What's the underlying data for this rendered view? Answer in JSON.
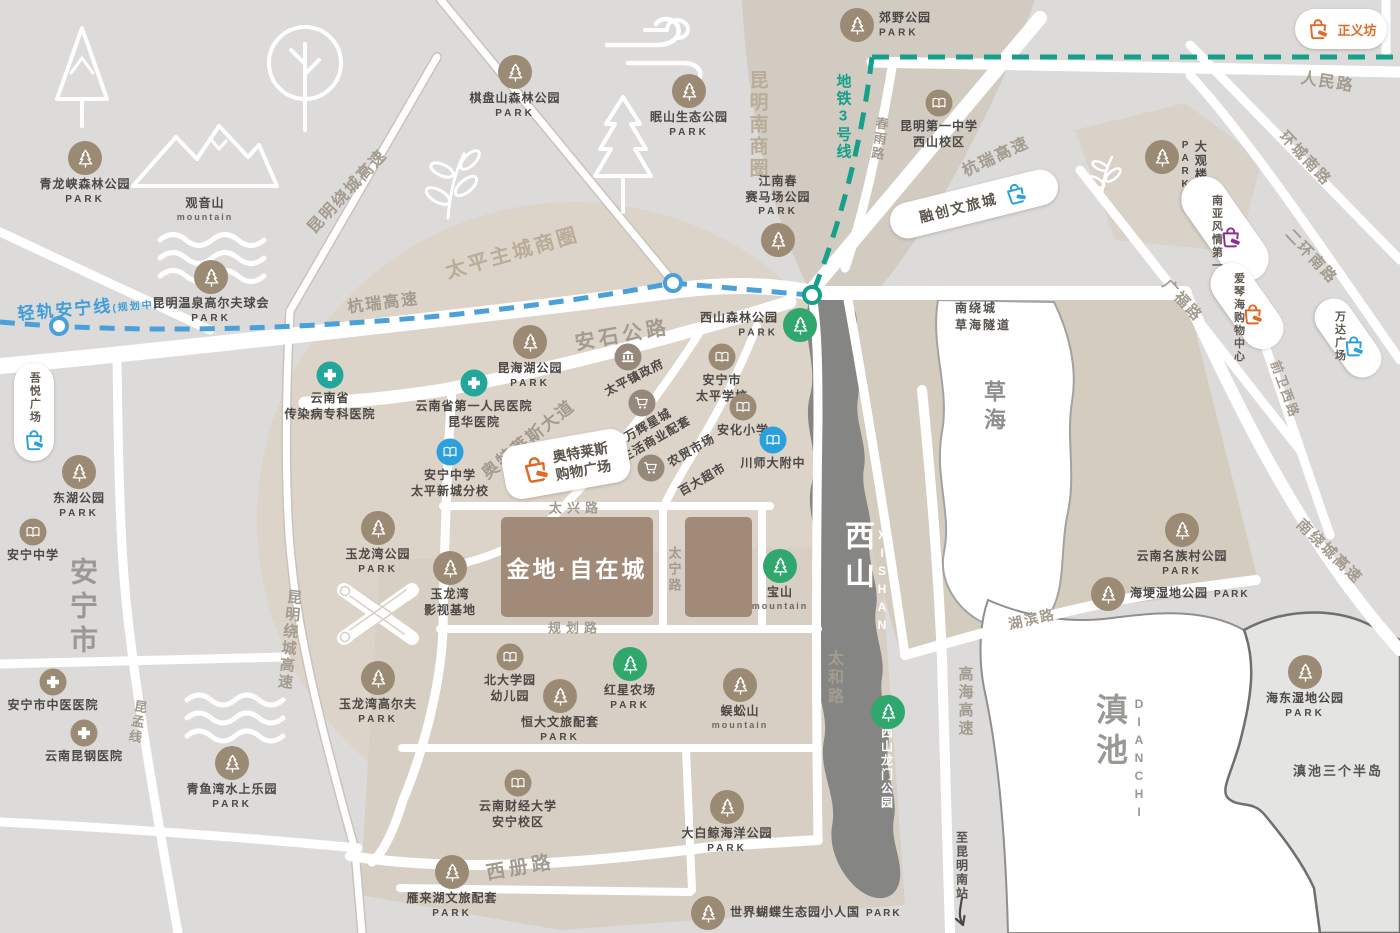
{
  "project": {
    "name": "金地·自在城"
  },
  "transit": {
    "metro": "地铁3号线",
    "lrt": "轻轨安宁线",
    "lrtNote": "(规划中)"
  },
  "areas": {
    "anning": "安宁市",
    "caohai": "草海",
    "xishan": "西山",
    "xishanEn": "XISHAN",
    "dianchi": "滇池",
    "dianchiEn": "DIANCHI",
    "bizSouth": "昆明南商圈",
    "bizTaiping": "太平主城商圈",
    "peninsula": "滇池三个半岛",
    "tunnel": "南绕城",
    "tunnel2": "草海隧道",
    "toStation": "至昆明南站"
  },
  "roads": {
    "raocheng": "昆明绕城高速",
    "hangrui": "杭瑞高速",
    "anshi": "安石公路",
    "aoteDadao": "奥特莱斯大道",
    "taixing": "太兴路",
    "guihua": "规划路",
    "taining": "太宁路",
    "xice": "西册路",
    "taihe": "太和路",
    "hubin": "湖滨路",
    "gaohai": "高海高速",
    "nanrao": "南绕城高速",
    "renmin": "人民路",
    "huancheng": "环城南路",
    "erhuan": "二环南路",
    "guangfu": "广福路",
    "qianwei": "前卫西路",
    "chunyu": "春雨路",
    "kunmeng": "昆孟线"
  },
  "malls": {
    "zhengyifang": "正义坊",
    "rongchuang": "融创文旅城",
    "nanya": "南亚风情第一城",
    "aiqinhai": "爱琴海购物中心",
    "wanda": "万达广场",
    "wuyue": "吾悦广场",
    "aotelaisi": {
      "l1": "奥特莱斯",
      "l2": "购物广场"
    }
  },
  "pois": {
    "qipanshan": {
      "n": "棋盘山森林公园",
      "s": "PARK"
    },
    "mianshan": {
      "n": "眠山生态公园",
      "s": "PARK"
    },
    "jiaoye": {
      "n": "郊野公园",
      "s": "PARK"
    },
    "jiangnan": {
      "n": "江南春",
      "n2": "赛马场公园",
      "s": "PARK"
    },
    "qinglongxia": {
      "n": "青龙峡森林公园",
      "s": "PARK"
    },
    "wenquan": {
      "n": "昆明温泉高尔夫球会",
      "s": "PARK"
    },
    "guanyinshan": {
      "n": "观音山",
      "e": "mountain"
    },
    "donghu": {
      "n": "东湖公园",
      "s": "PARK"
    },
    "yulongwanpark": {
      "n": "玉龙湾公园",
      "s": "PARK"
    },
    "yulongwanfilm": {
      "n": "玉龙湾",
      "n2": "影视基地"
    },
    "yulongwangolf": {
      "n": "玉龙湾高尔夫",
      "s": "PARK"
    },
    "qingyuwan": {
      "n": "青鱼湾水上乐园",
      "s": "PARK"
    },
    "kunhaihu": {
      "n": "昆海湖公园",
      "s": "PARK"
    },
    "yanlaihu": {
      "n": "雁来湖文旅配套",
      "s": "PARK"
    },
    "hengda": {
      "n": "恒大文旅配套",
      "s": "PARK"
    },
    "dabaijing": {
      "n": "大白鲸海洋公园",
      "s": "PARK"
    },
    "butterfly": {
      "n": "世界蝴蝶生态园小人国",
      "s": "PARK"
    },
    "haigeng": {
      "n": "海埂湿地公园",
      "s": "PARK"
    },
    "minzucun": {
      "n": "云南名族村公园",
      "s": "PARK"
    },
    "haidong": {
      "n": "海东湿地公园",
      "s": "PARK"
    },
    "wugongshan": {
      "n": "蜈蚣山",
      "e": "mountain"
    },
    "daguanlou": {
      "n": "大观楼公园",
      "s": "PARK"
    },
    "xishansenlin": {
      "n": "西山森林公园",
      "s": "PARK"
    },
    "baoshan": {
      "n": "宝山",
      "e": "mountain"
    },
    "hongxing": {
      "n": "红星农场",
      "s": "PARK"
    },
    "longmen": {
      "n": "西山龙门公园"
    },
    "km1": {
      "n": "昆明第一中学",
      "n2": "西山校区"
    },
    "anningfx": {
      "n": "安宁中学",
      "n2": "太平新城分校"
    },
    "anningzx": {
      "n": "安宁中学"
    },
    "taipingschool": {
      "n": "安宁市",
      "n2": "太平学校"
    },
    "anhua": {
      "n": "安化小学"
    },
    "chuanshi": {
      "n": "川师大附中"
    },
    "beidakid": {
      "n": "北大学园",
      "n2": "幼儿园"
    },
    "caijing": {
      "n": "云南财经大学",
      "n2": "安宁校区"
    },
    "yn1": {
      "n": "云南省第一人民医院",
      "n2": "昆华医院"
    },
    "chuanran": {
      "n": "云南省",
      "n2": "传染病专科医院"
    },
    "tcm": {
      "n": "安宁市中医医院"
    },
    "kungang": {
      "n": "云南昆钢医院"
    },
    "taipingzhen": {
      "n": "太平镇政府"
    },
    "wanhui": {
      "n": "万辉星城",
      "n2": "生活商业配套"
    },
    "nongmao": {
      "n": "农贸市场"
    },
    "baida": {
      "n": "百大超市"
    }
  },
  "colors": {
    "parkBrown": "#9b8a74",
    "parkGreen": "#2fa76d",
    "schoolBlue": "#2aa0dc",
    "hospitalTeal": "#23a79b",
    "metroTeal": "#169f89",
    "lrtBlue": "#4aa0d8",
    "mallOrange": "#e06a28",
    "mallPurple": "#8f2d90",
    "projectBrown": "#a28a78",
    "mountainGrey": "#858583",
    "roadLabel": "#a39b8f",
    "areaBeige": "#b9ac99"
  }
}
